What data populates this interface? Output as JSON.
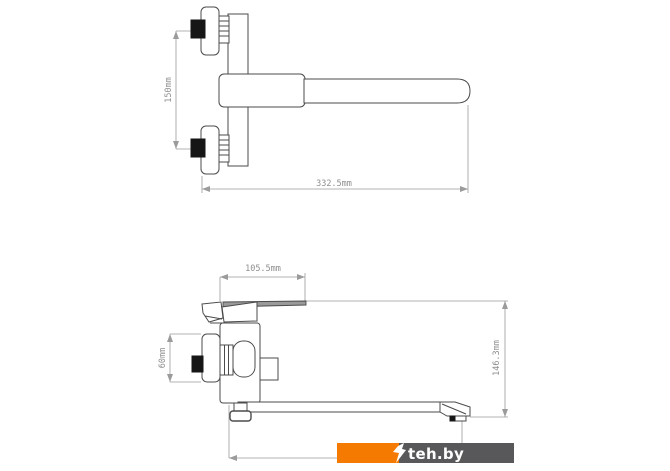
{
  "drawing": {
    "type": "technical-diagram",
    "subject": "wall-mounted bath mixer faucet, two projection views",
    "line_color": "#4b4b4b",
    "dimension_color": "#9b9b9b",
    "views": {
      "front": {
        "name": "front view (long spout)",
        "dimensions": {
          "inlet_spacing": "150mm",
          "overall_length": "332.5mm"
        }
      },
      "side": {
        "name": "side view (lever handle)",
        "dimensions": {
          "body_depth": "105.5mm",
          "escutcheon_diameter": "60mm",
          "overall_height": "146.3mm"
        }
      }
    }
  },
  "watermark": {
    "text": "teh.by",
    "orange": "#f57a01",
    "gray": "#58585a",
    "text_color": "#ffffff"
  }
}
